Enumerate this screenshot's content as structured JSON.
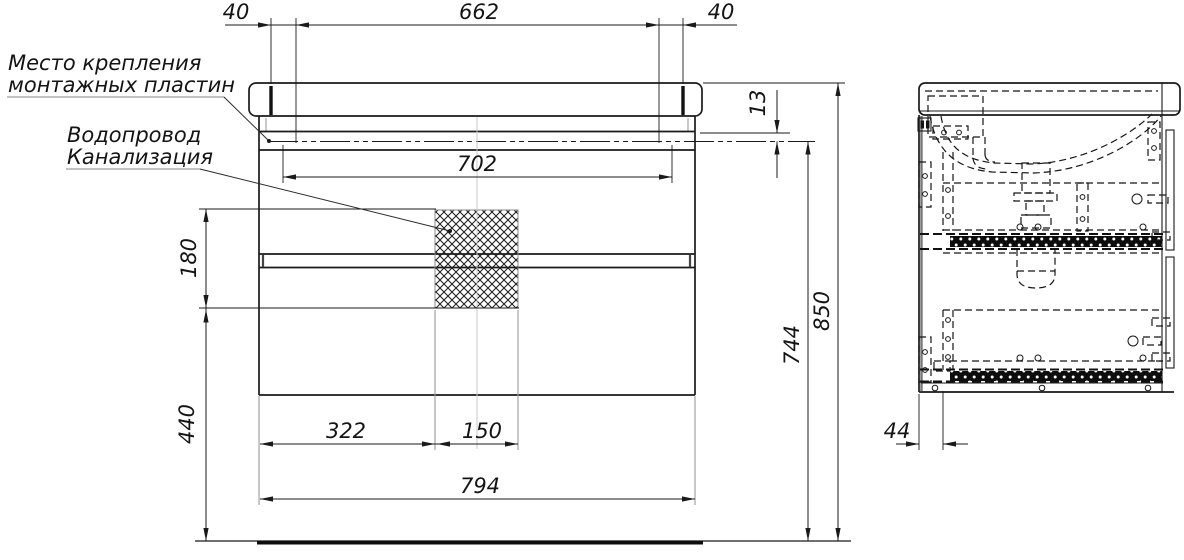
{
  "labels": {
    "mounting_plates_line1": "Место крепления",
    "mounting_plates_line2": "монтажных пластин",
    "plumbing_line1": "Водопровод",
    "plumbing_line2": "Канализация"
  },
  "dimensions": {
    "top_left_offset": "40",
    "mount_span": "662",
    "top_right_offset": "40",
    "inner_width": "702",
    "top_inset": "13",
    "mount_height": "744",
    "total_height": "850",
    "service_zone_height": "180",
    "service_zone_bottom": "440",
    "drain_offset_x": "322",
    "drain_zone_width": "150",
    "cabinet_width": "794",
    "side_front_inset": "44"
  },
  "colors": {
    "line": "#1a1a1a",
    "extension_gray": "#9a9a9a",
    "background": "#ffffff"
  }
}
